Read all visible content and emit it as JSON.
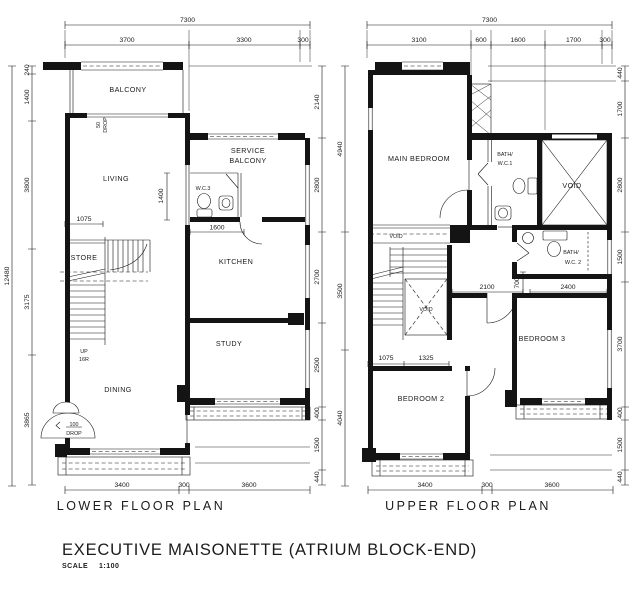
{
  "title": {
    "main": "EXECUTIVE MAISONETTE (ATRIUM BLOCK-END)",
    "scale_label": "SCALE",
    "scale_value": "1:100"
  },
  "lower": {
    "caption": "LOWER FLOOR PLAN",
    "rooms": {
      "balcony": "BALCONY",
      "living": "LIVING",
      "store": "STORE",
      "dining": "DINING",
      "service_1": "SERVICE",
      "service_2": "BALCONY",
      "wc3": "W.C.3",
      "kitchen": "KITCHEN",
      "study": "STUDY"
    },
    "ann": {
      "drop50_a": "50",
      "drop50_b": "DROP",
      "up": "UP",
      "riser": "16R",
      "drop100_a": "100",
      "drop100_b": "DROP"
    },
    "dims": {
      "top_total": "7300",
      "top": [
        "3700",
        "3300",
        "300"
      ],
      "left_total": "12480",
      "left": [
        "240",
        "1400",
        "3800",
        "3175",
        "3865"
      ],
      "right": [
        "2140",
        "2800",
        "2700",
        "2500",
        "400",
        "1500",
        "440"
      ],
      "bottom": [
        "3400",
        "300",
        "3600"
      ],
      "inner": {
        "w1075": "1075",
        "h1400": "1400",
        "w1600": "1600"
      }
    }
  },
  "upper": {
    "caption": "UPPER FLOOR PLAN",
    "rooms": {
      "main_bedroom": "MAIN BEDROOM",
      "bath1_a": "BATH/",
      "bath1_b": "W.C.1",
      "void_big": "VOID",
      "void_strip": "VOID",
      "void_mid": "VOID",
      "bath2_a": "BATH/",
      "bath2_b": "W.C. 2",
      "bedroom3": "BEDROOM 3",
      "bedroom2": "BEDROOM 2"
    },
    "dims": {
      "top_total": "7300",
      "top": [
        "3100",
        "600",
        "1600",
        "1700",
        "300"
      ],
      "left": [
        "4940",
        "3500",
        "4040"
      ],
      "right": [
        "440",
        "1700",
        "2800",
        "1500",
        "3700",
        "400",
        "1500",
        "440"
      ],
      "bottom": [
        "3400",
        "300",
        "3600"
      ],
      "inner": {
        "w2100": "2100",
        "h700": "700",
        "w2400": "2400",
        "w1075": "1075",
        "w1325": "1325"
      }
    }
  }
}
